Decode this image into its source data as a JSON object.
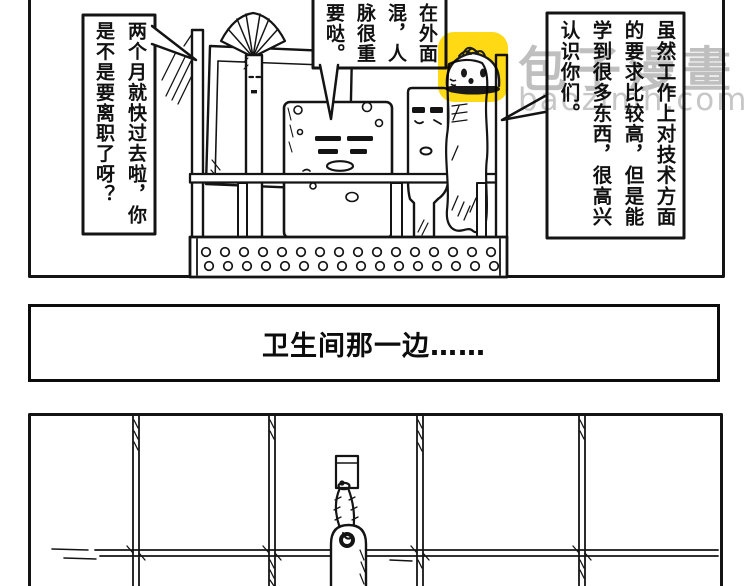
{
  "comic": {
    "panel1": {
      "bubble_left_text": "两个月就快过去啦，你是不是要离职了呀？",
      "bubble_middle_text": "在外面混，人脉很重要哒。",
      "bubble_right_text": "虽然工作上对技术方面的要求比较高，但是能学到很多东西，很高兴认识你们。",
      "scene": "bathroom shelf basket with toothbrush, soap and toothpaste characters"
    },
    "panel2": {
      "caption": "卫生间那一边……"
    },
    "panel3": {
      "scene": "tiled wall with a key tag hanging from a hook"
    }
  },
  "watermark": {
    "brand": "包子漫畫",
    "site": "baozimh.com",
    "icon": "baozi-bun-icon"
  },
  "colors": {
    "ink": "#141414",
    "paper": "#FFFFFF",
    "watermark_yellow": "#FFD913",
    "watermark_gray": "#BFBFBF"
  }
}
